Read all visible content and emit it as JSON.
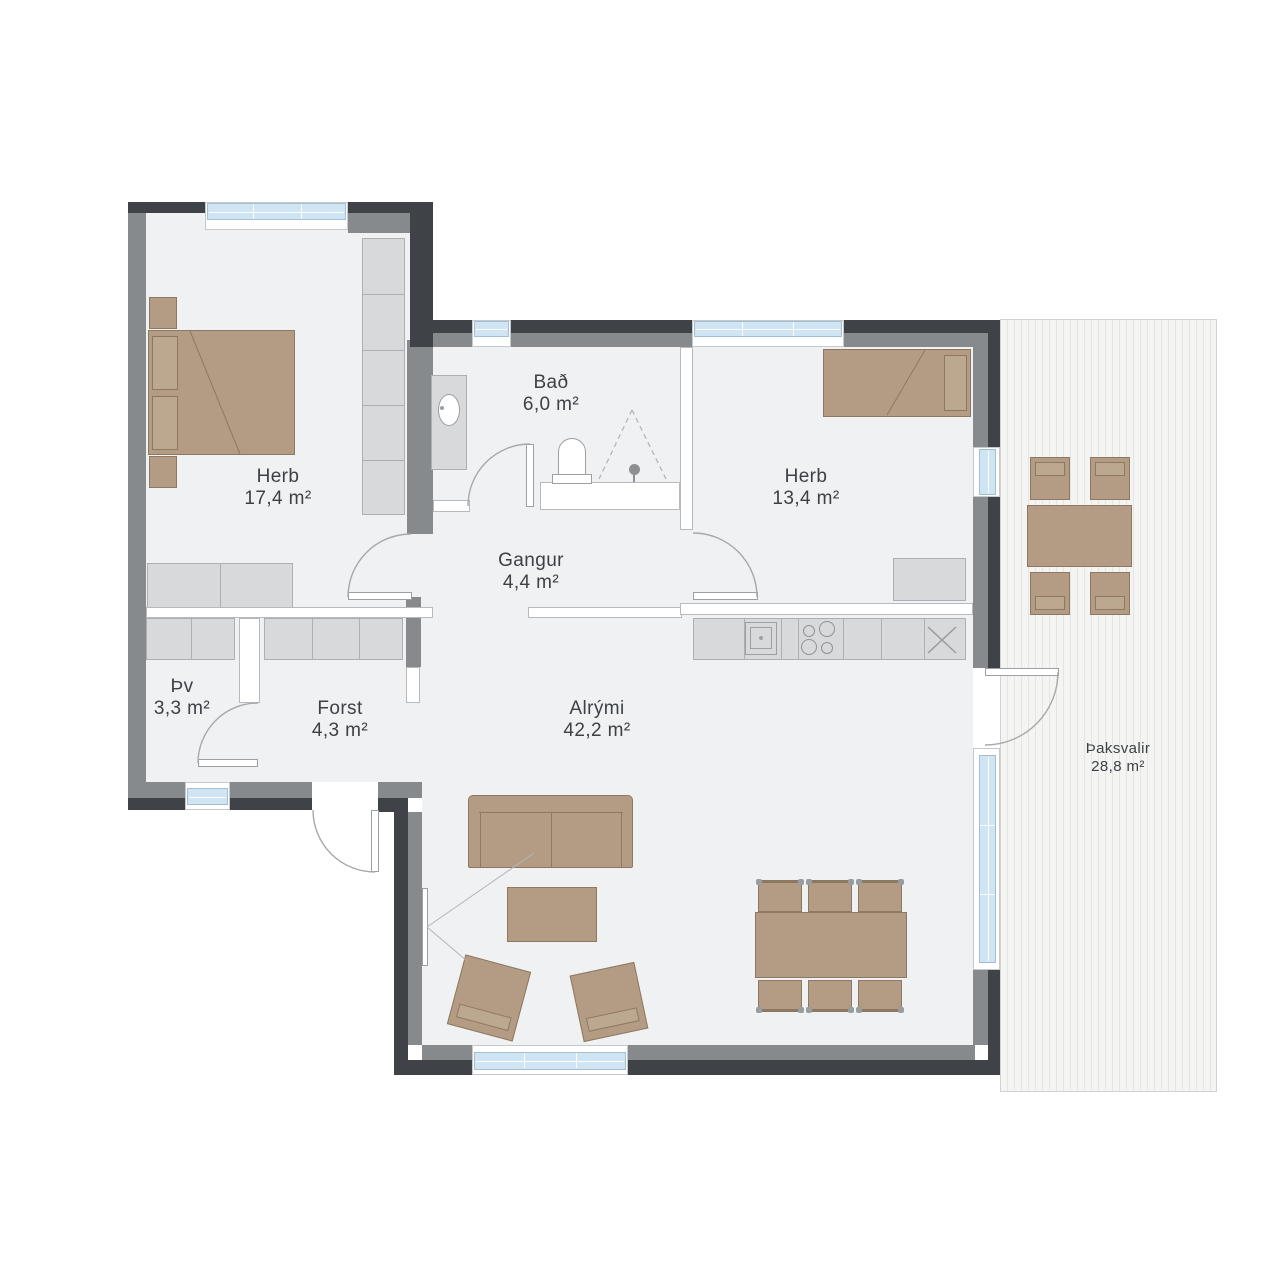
{
  "title": "Floor plan",
  "rooms": {
    "bedroom1": {
      "name": "Herb",
      "area": "17,4 m²"
    },
    "bathroom": {
      "name": "Bað",
      "area": "6,0 m²"
    },
    "bedroom2": {
      "name": "Herb",
      "area": "13,4 m²"
    },
    "hallway": {
      "name": "Gangur",
      "area": "4,4 m²"
    },
    "laundry": {
      "name": "Þv",
      "area": "3,3 m²"
    },
    "entry": {
      "name": "Forst",
      "area": "4,3 m²"
    },
    "living": {
      "name": "Alrými",
      "area": "42,2 m²"
    },
    "terrace": {
      "name": "Þaksvalir",
      "area": "28,8 m²"
    }
  },
  "colors": {
    "wall_dark": "#3f4347",
    "wall_gray": "#868a8d",
    "interior_wall": "#ffffff",
    "floor": "#f0f1f3",
    "furniture_tan": "#b39c83",
    "furniture_light": "#d7d9da",
    "window_blue": "#cfe5f3",
    "deck_stripe": "#e5e5e3",
    "text": "#3c4146"
  }
}
